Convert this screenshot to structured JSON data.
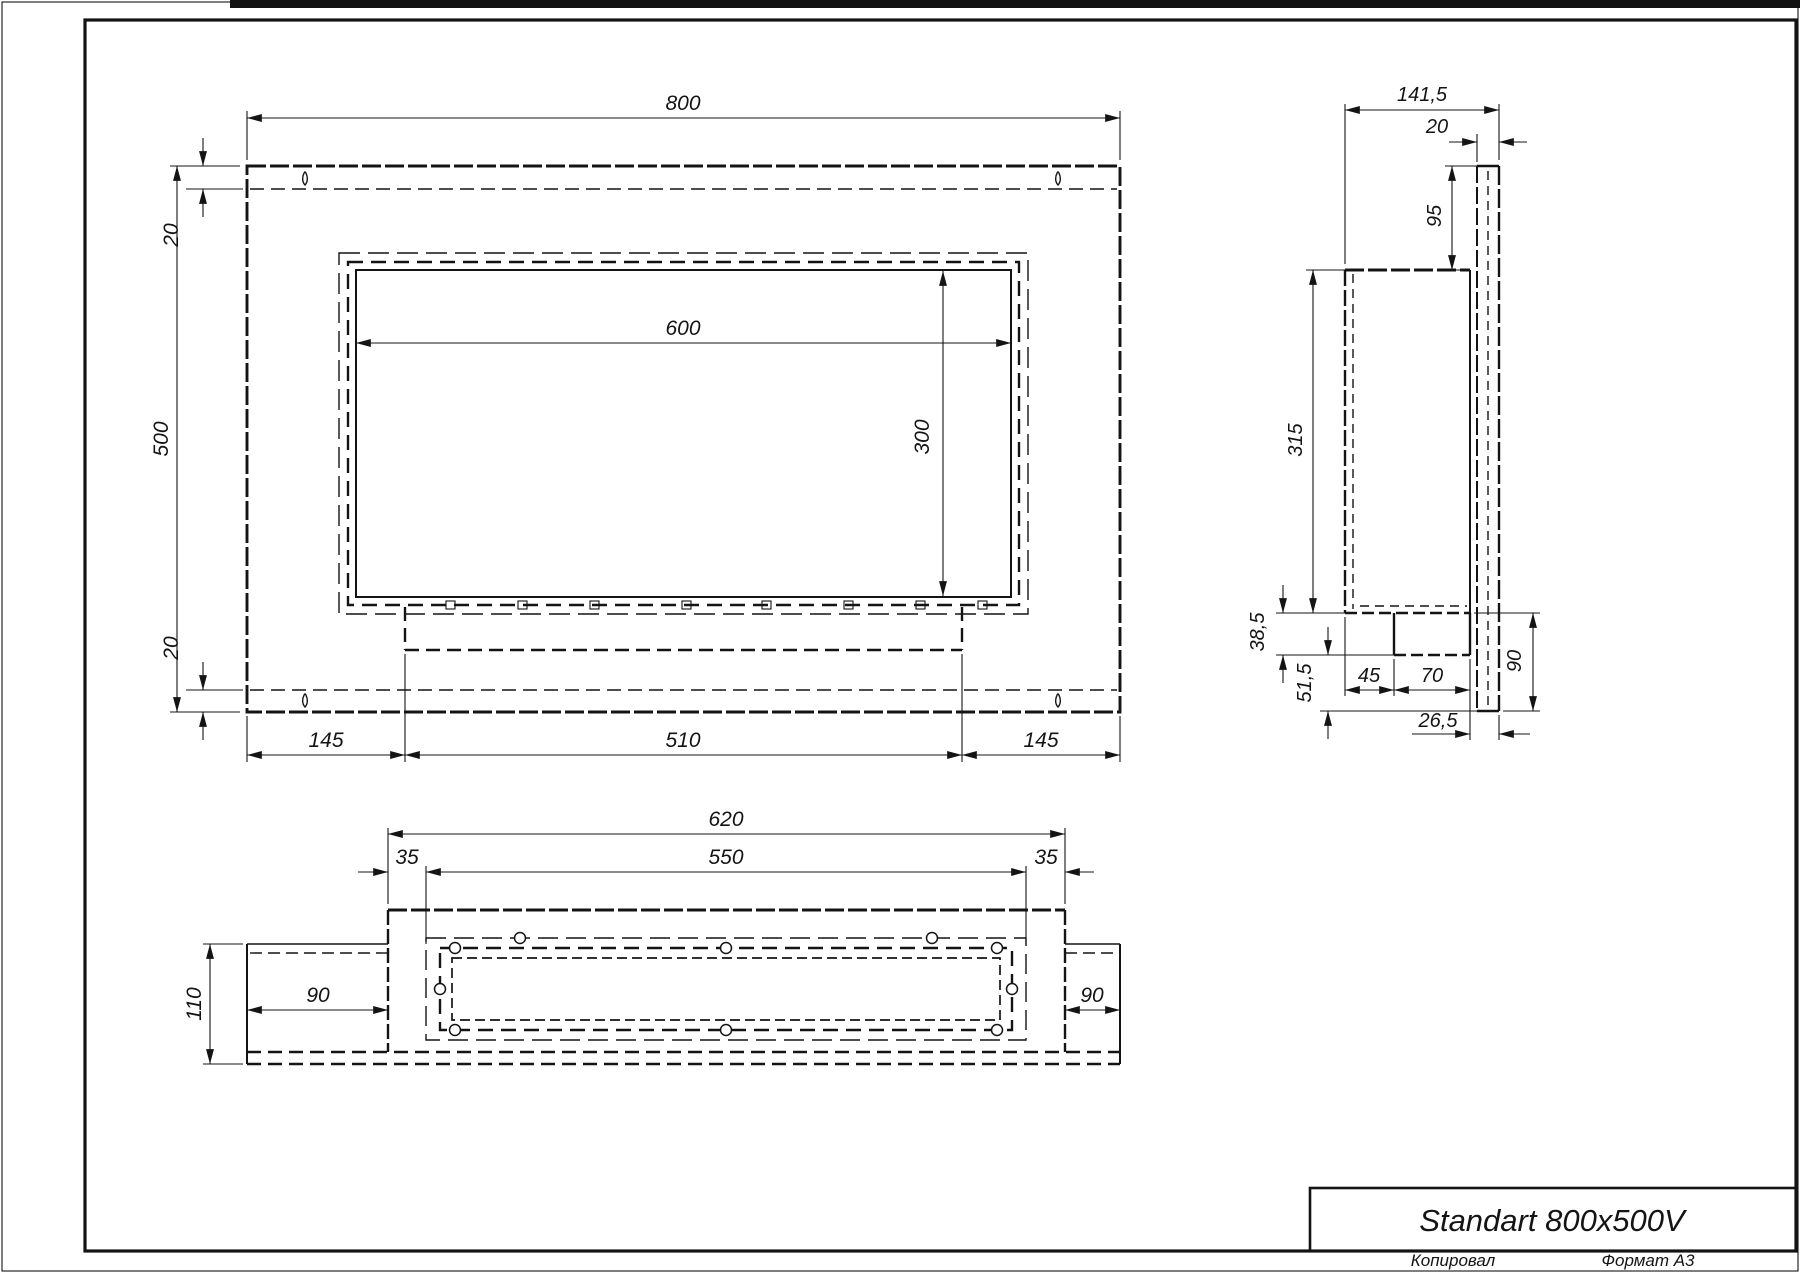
{
  "page": {
    "copied_label": "Копировал",
    "format_label": "Формат A3"
  },
  "title_block": {
    "product_name": "Standart 800x500V"
  },
  "front_view": {
    "width_total": "800",
    "height_total": "500",
    "top_inset": "20",
    "bottom_inset": "20",
    "opening_width": "600",
    "opening_height": "300",
    "left_offset": "145",
    "burner_length": "510",
    "right_offset": "145"
  },
  "side_view": {
    "depth_total": "141,5",
    "frame_thickness": "20",
    "top_to_box": "95",
    "box_height": "315",
    "tray_drop": "38,5",
    "below_tray": "51,5",
    "tray_offset": "45",
    "tray_width": "70",
    "below_box": "90",
    "back_gap": "26,5"
  },
  "bottom_view": {
    "box_width": "620",
    "flange_width": "550",
    "flange_inset_left": "35",
    "flange_inset_right": "35",
    "depth": "110",
    "wing_left": "90",
    "wing_right": "90"
  },
  "colors": {
    "ink": "#141414",
    "paper": "#ffffff"
  }
}
